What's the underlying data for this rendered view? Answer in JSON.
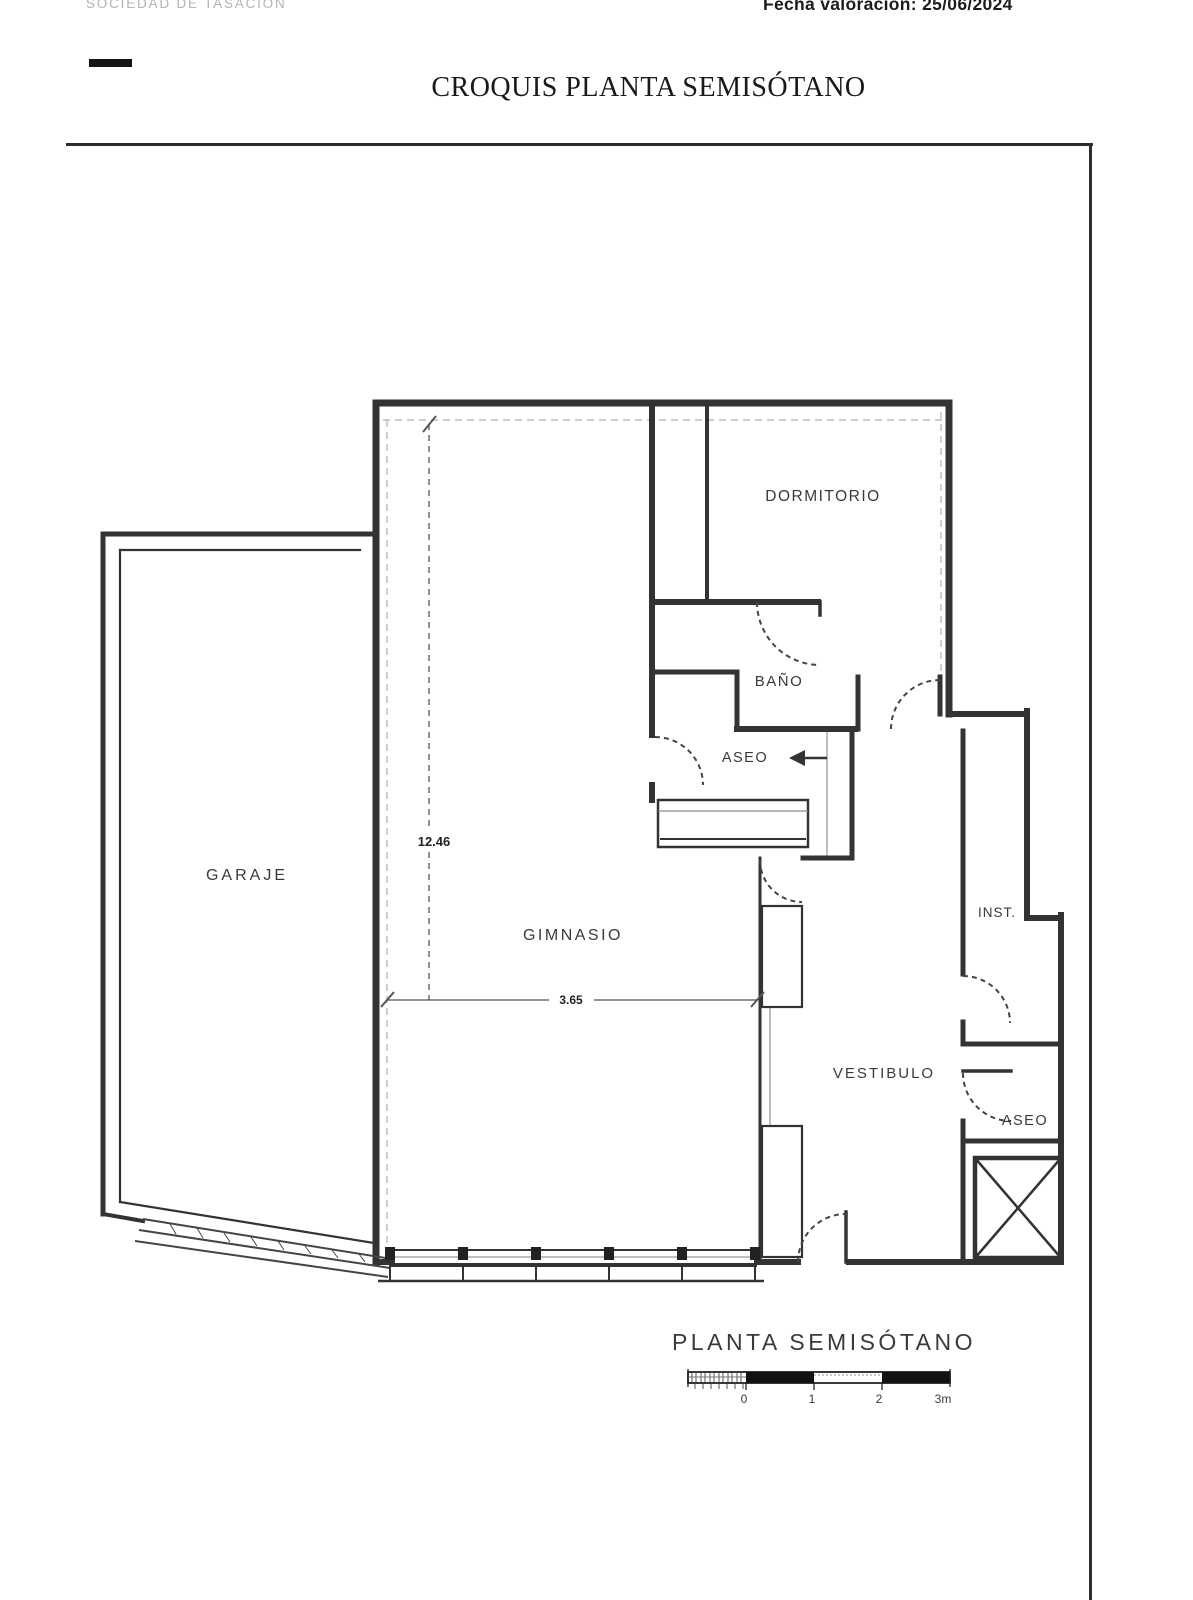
{
  "header": {
    "org": "SOCIEDAD DE TASACIÓN",
    "valuation": "Fecha valoración: 25/06/2024",
    "title": "CROQUIS PLANTA SEMISÓTANO"
  },
  "plan": {
    "caption": "PLANTA SEMISÓTANO",
    "rooms": {
      "garaje": "GARAJE",
      "gimnasio": "GIMNASIO",
      "dormitorio": "DORMITORIO",
      "bano": "BAÑO",
      "aseo_central": "ASEO",
      "vestibulo": "VESTIBULO",
      "inst": "INST.",
      "aseo_right": "ASEO"
    },
    "dimensions": {
      "height": "12.46",
      "width": "3.65"
    },
    "scale_bar": {
      "tick_labels": [
        "0",
        "1",
        "2",
        "3m"
      ]
    }
  }
}
